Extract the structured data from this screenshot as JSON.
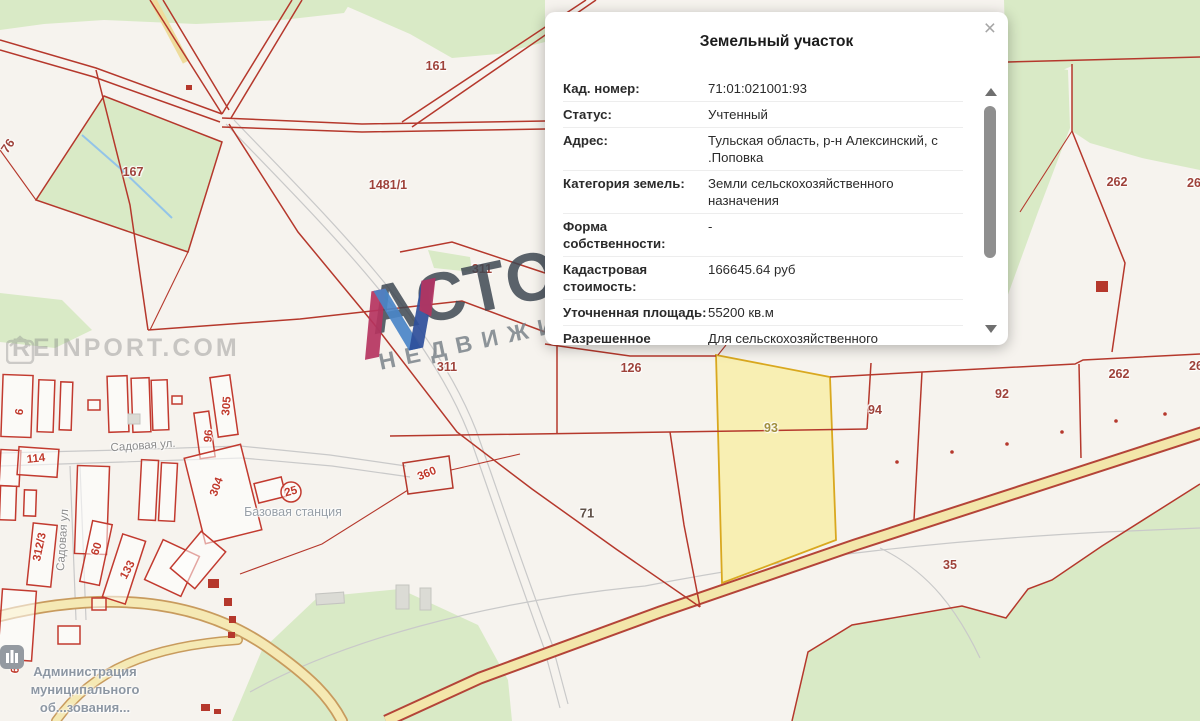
{
  "popup": {
    "title": "Земельный участок",
    "close_label": "×",
    "rows": [
      {
        "label": "Кад. номер:",
        "value": "71:01:021001:93"
      },
      {
        "label": "Статус:",
        "value": "Учтенный"
      },
      {
        "label": "Адрес:",
        "value": "Тульская область, р-н Алексинский, с .Поповка"
      },
      {
        "label": "Категория земель:",
        "value": "Земли сельскохозяйственного назначения"
      },
      {
        "label": "Форма собственности:",
        "value": "-"
      },
      {
        "label": "Кадастровая стоимость:",
        "value": "166645.64 руб"
      },
      {
        "label": "Уточненная площадь:",
        "value": "55200 кв.м"
      },
      {
        "label": "Разрешенное",
        "value": "Для сельскохозяйственного"
      }
    ]
  },
  "watermarks": {
    "corner_text": "REINPORT.COM",
    "brand_title": "АСТОРИЯ",
    "brand_subtitle": "НЕДВИЖИМОСТЬ"
  },
  "map": {
    "admin_lines": [
      "Администрация",
      "муниципального",
      "об...зования..."
    ],
    "labels": [
      {
        "text": "161",
        "x": 436,
        "y": 66,
        "rot": 0,
        "cls": "p"
      },
      {
        "text": "167",
        "x": 133,
        "y": 172,
        "rot": 0,
        "cls": "p"
      },
      {
        "text": "1481/1",
        "x": 388,
        "y": 185,
        "rot": 0,
        "cls": "p"
      },
      {
        "text": "76",
        "x": 8,
        "y": 146,
        "rot": -55,
        "cls": "p"
      },
      {
        "text": "311",
        "x": 482,
        "y": 269,
        "rot": 0,
        "cls": "p"
      },
      {
        "text": "311",
        "x": 447,
        "y": 367,
        "rot": 0,
        "cls": "p"
      },
      {
        "text": "126",
        "x": 631,
        "y": 368,
        "rot": 0,
        "cls": "p"
      },
      {
        "text": "262",
        "x": 1117,
        "y": 182,
        "rot": 0,
        "cls": "p"
      },
      {
        "text": "26",
        "x": 1194,
        "y": 183,
        "rot": 0,
        "cls": "p"
      },
      {
        "text": "262",
        "x": 1119,
        "y": 374,
        "rot": 0,
        "cls": "p"
      },
      {
        "text": "26",
        "x": 1196,
        "y": 366,
        "rot": 0,
        "cls": "p"
      },
      {
        "text": "92",
        "x": 1002,
        "y": 394,
        "rot": 0,
        "cls": "p"
      },
      {
        "text": "94",
        "x": 875,
        "y": 410,
        "rot": 0,
        "cls": "p"
      },
      {
        "text": "35",
        "x": 950,
        "y": 565,
        "rot": 0,
        "cls": "p"
      },
      {
        "text": "93",
        "x": 771,
        "y": 428,
        "rot": 0,
        "cls": "olive"
      },
      {
        "text": "71",
        "x": 587,
        "y": 513,
        "rot": 0,
        "cls": "dark"
      },
      {
        "text": "360",
        "x": 427,
        "y": 474,
        "rot": -22,
        "cls": "pv"
      },
      {
        "text": "305",
        "x": 227,
        "y": 406,
        "rot": -85,
        "cls": "pv"
      },
      {
        "text": "96",
        "x": 209,
        "y": 436,
        "rot": -85,
        "cls": "pv"
      },
      {
        "text": "304",
        "x": 217,
        "y": 487,
        "rot": -70,
        "cls": "pv"
      },
      {
        "text": "114",
        "x": 36,
        "y": 459,
        "rot": -6,
        "cls": "pv"
      },
      {
        "text": "312/3",
        "x": 40,
        "y": 547,
        "rot": -78,
        "cls": "pv"
      },
      {
        "text": "60",
        "x": 97,
        "y": 549,
        "rot": -72,
        "cls": "pv"
      },
      {
        "text": "133",
        "x": 128,
        "y": 570,
        "rot": -62,
        "cls": "pv"
      },
      {
        "text": "63",
        "x": 16,
        "y": 667,
        "rot": -85,
        "cls": "pv"
      },
      {
        "text": "25",
        "x": 291,
        "y": 492,
        "rot": -15,
        "cls": "pv"
      },
      {
        "text": "6",
        "x": 20,
        "y": 412,
        "rot": -80,
        "cls": "pv"
      },
      {
        "text": "Садовая ул.",
        "x": 143,
        "y": 446,
        "rot": -4,
        "cls": "street"
      },
      {
        "text": "Садовая ул",
        "x": 63,
        "y": 540,
        "rot": -86,
        "cls": "street"
      },
      {
        "text": "Базовая станция",
        "x": 293,
        "y": 512,
        "rot": 0,
        "cls": "poi"
      }
    ]
  },
  "colors": {
    "boundary_red": "#b5382c",
    "forest_green": "#d9eac6",
    "highlight_parcel_fill": "#f8efb3",
    "highlight_parcel_border": "#d9a81f",
    "road_fill": "#f3e6aa",
    "label_red": "#9e423a",
    "village_label_red": "#c0392b"
  }
}
